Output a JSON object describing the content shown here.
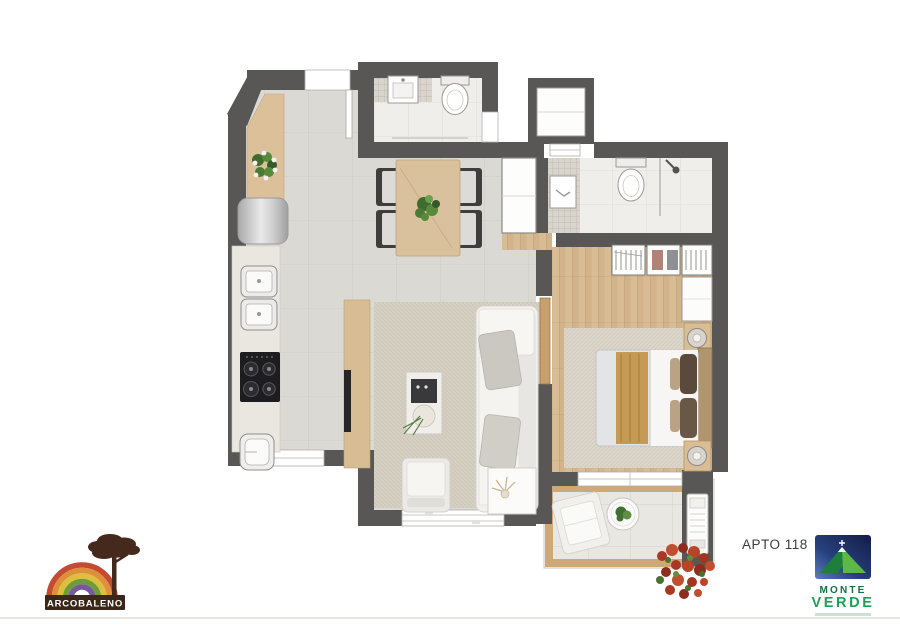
{
  "meta": {
    "unit_label": "APTO 118"
  },
  "branding": {
    "arcobaleno": {
      "name": "ARCOBALENO"
    },
    "monte_verde": {
      "word1": "MONTE",
      "word2": "VERDE"
    }
  },
  "palette": {
    "wall": "#595755",
    "floor_tile": "#dbd9d4",
    "wood_floor": "#d8bc96",
    "counter_wood": "#dcc09a",
    "bath_floor": "#efeeeb",
    "mosaic": "#d9d4cc",
    "rug": "#d6d0c3",
    "balcony_wood": "#cfa878",
    "balcony_tile": "#e9e7e1",
    "plant_green": "#4e7a38",
    "flower_red": "#b13c29",
    "logo_brown": "#3a2719",
    "logo_green": "#1ba258",
    "logo_navy": "#1e2f66"
  }
}
